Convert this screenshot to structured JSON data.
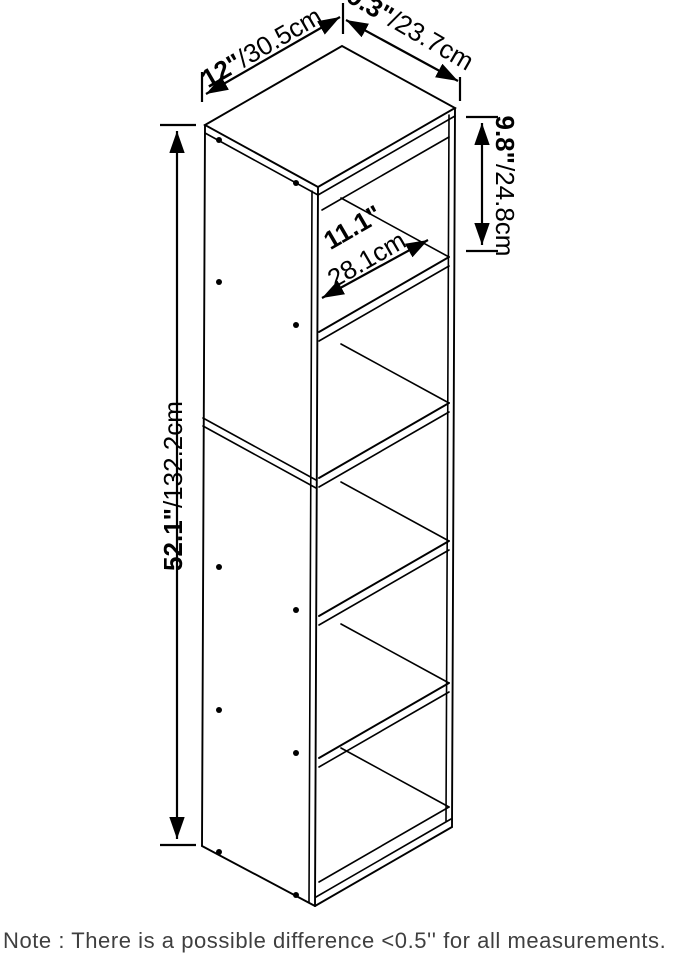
{
  "diagram": {
    "title": "storage-cube-shelf-dimension-drawing",
    "dims": {
      "width": {
        "inches": "12\"",
        "cm": "/30.5cm"
      },
      "depth": {
        "inches": "9.3\"",
        "cm": "/23.7cm"
      },
      "cube_height": {
        "inches": "9.8\"",
        "cm": "/24.8cm"
      },
      "cube_diagonal": {
        "inches": "11.1\"",
        "cm": "28.1cm"
      },
      "total_height": {
        "inches": "52.1\"",
        "cm": "/132.2cm"
      }
    },
    "note": "Note : There is a possible difference <0.5'' for all measurements.",
    "colors": {
      "line": "#000000",
      "note_text": "#3f3f3f",
      "background": "#ffffff"
    },
    "structure": {
      "cube_count": 5,
      "visible_faces": [
        "top",
        "left-side-panel",
        "open-front"
      ]
    }
  }
}
